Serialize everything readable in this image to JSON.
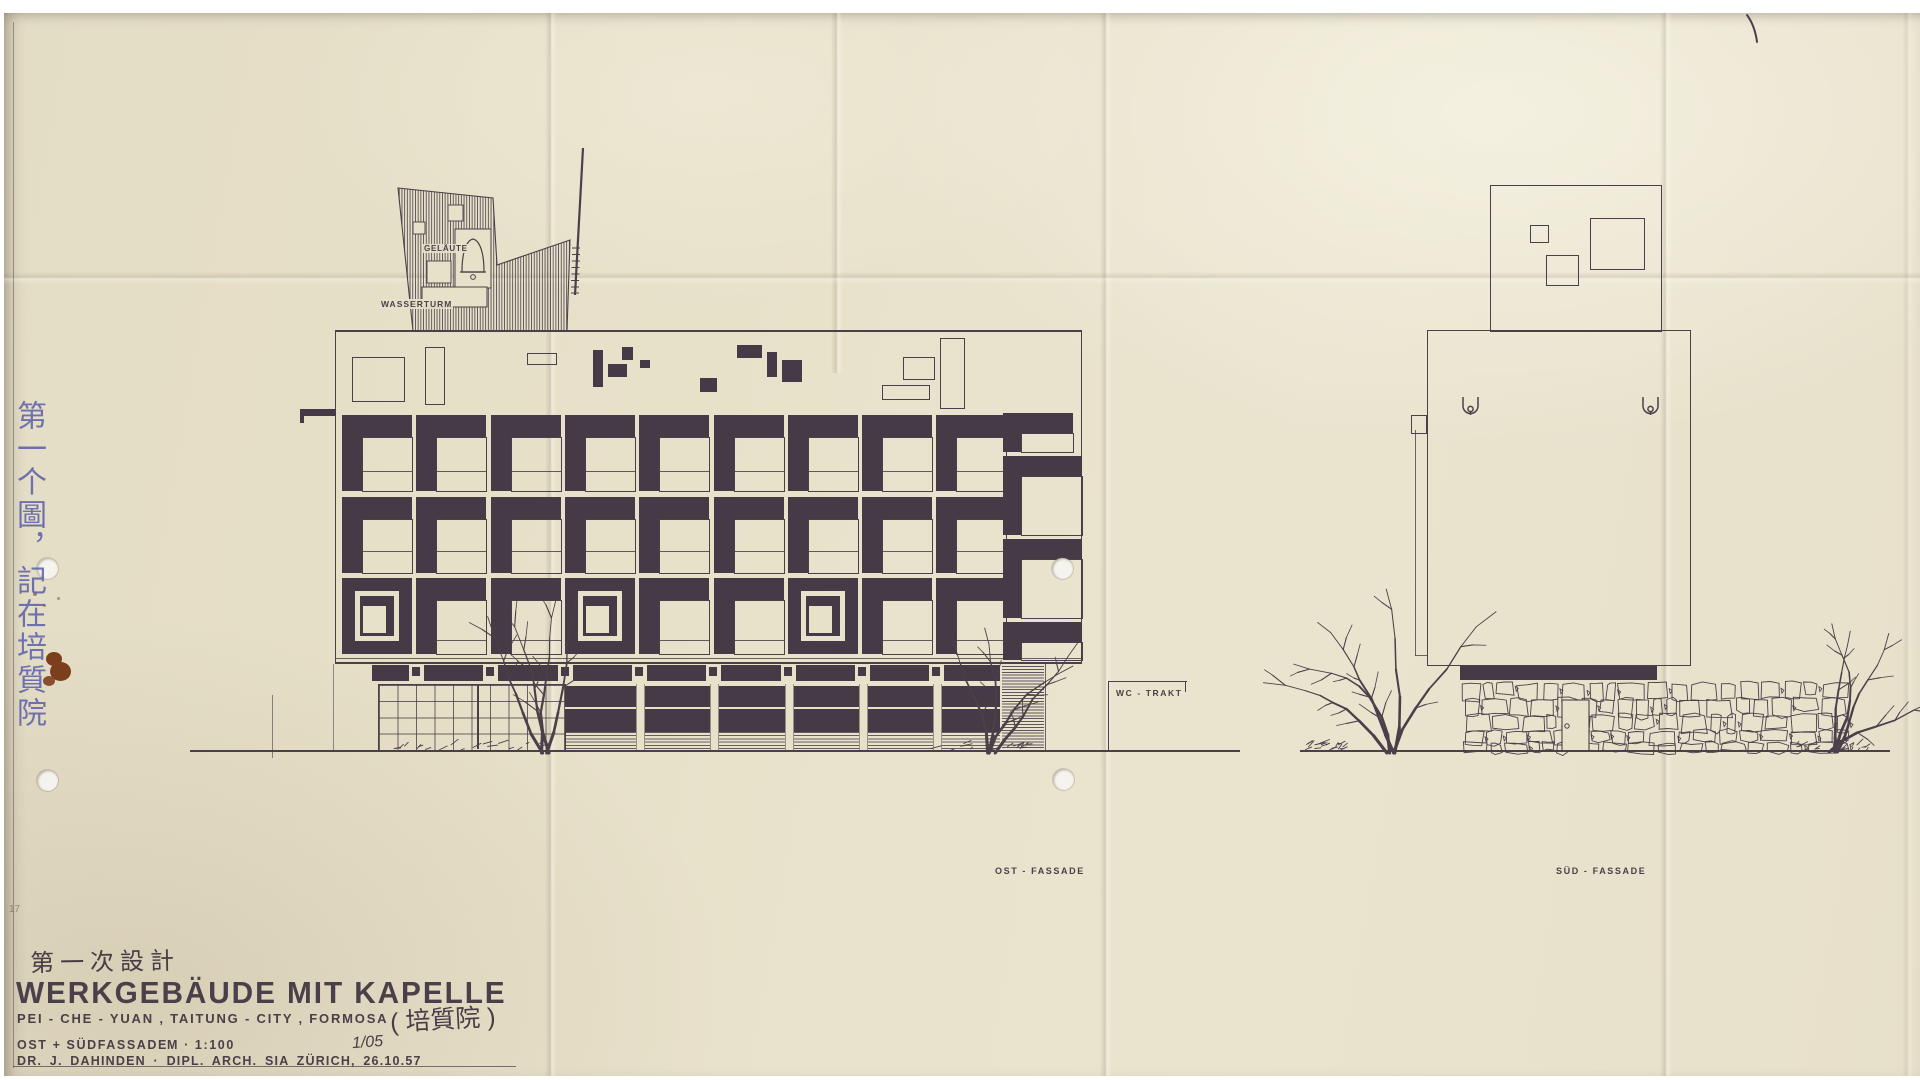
{
  "document": {
    "sheet_title": "WERKGEBÄUDE  MIT  KAPELLE",
    "location_line": "PEI - CHE - YUAN ,  TAITUNG - CITY ,  FORMOSA",
    "location_annotation_cjk": "( 培質院 )",
    "design_phase_note_cjk": "第一次設計",
    "margin_note_cjk_vertical": "第一个圖，記在培質院",
    "views_line": "OST + SÜDFASSADE",
    "scale": "M · 1:100",
    "sheet_number": "1/05",
    "architect_line": "DR. J. DAHINDEN · DIPL. ARCH. SIA  ZÜRICH, 26.10.57",
    "corner_mark": "17"
  },
  "annotations": {
    "bell_label": "GELÄUTE",
    "water_tower_label": "WASSERTURM",
    "wc_label": "WC - TRAKT",
    "east_view_label": "OST - FASSADE",
    "south_view_label": "SÜD - FASSADE"
  },
  "colors": {
    "paper": "#e8e1ca",
    "ink": "#4a4049",
    "dark_fill": "#453a45",
    "blue_ink": "#5f63ab",
    "rust_stain": "#7c3f1e",
    "punch_hole": "#f4f3ee"
  },
  "east_facade": {
    "grid": {
      "left": 342,
      "top": 415,
      "cols": 9,
      "rows": 3,
      "cell_w": 70,
      "cell_h": 76,
      "pitch_x": 74.3,
      "pitch_y": 81.5,
      "top_bar": 22,
      "left_bar": 20,
      "mullion_frac": [
        0.63,
        0.6,
        0.74
      ],
      "ring_cells": [
        [
          2,
          0
        ],
        [
          2,
          3
        ],
        [
          2,
          6
        ]
      ]
    },
    "stair_cells": [
      [
        1003,
        413,
        70,
        39
      ],
      [
        1003,
        456,
        79,
        79
      ],
      [
        1003,
        539,
        79,
        79
      ],
      [
        1003,
        622,
        79,
        38
      ]
    ],
    "roof_shapes_outline": [
      [
        352,
        357,
        51,
        43
      ],
      [
        425,
        347,
        18,
        56
      ],
      [
        527,
        353,
        28,
        10
      ],
      [
        903,
        357,
        30,
        21
      ],
      [
        882,
        385,
        46,
        13
      ],
      [
        940,
        338,
        23,
        69
      ]
    ],
    "roof_shapes_solid": [
      [
        593,
        350,
        10,
        37
      ],
      [
        608,
        364,
        19,
        13
      ],
      [
        622,
        347,
        11,
        13
      ],
      [
        640,
        360,
        10,
        8
      ],
      [
        700,
        378,
        17,
        14
      ],
      [
        737,
        345,
        25,
        13
      ],
      [
        767,
        352,
        10,
        25
      ],
      [
        782,
        360,
        20,
        22
      ]
    ],
    "spandrel_piers_x": [
      416,
      490,
      565,
      639,
      713,
      788,
      862,
      936
    ],
    "pilasters_x": [
      639,
      713,
      788,
      862,
      936
    ]
  },
  "south_facade": {
    "roof_box_squares": [
      [
        1530,
        225,
        17,
        16
      ],
      [
        1546,
        255,
        31,
        29
      ],
      [
        1590,
        218,
        53,
        50
      ]
    ],
    "scupper_positions": [
      [
        1462,
        396
      ],
      [
        1642,
        396
      ]
    ]
  },
  "vegetation": {
    "trees": [
      {
        "x": 545,
        "y": 753,
        "h": 150,
        "lean": -6
      },
      {
        "x": 992,
        "y": 753,
        "h": 132,
        "lean": 16
      },
      {
        "x": 1390,
        "y": 753,
        "h": 152,
        "lean": -8
      },
      {
        "x": 1833,
        "y": 752,
        "h": 128,
        "lean": 22
      }
    ]
  }
}
